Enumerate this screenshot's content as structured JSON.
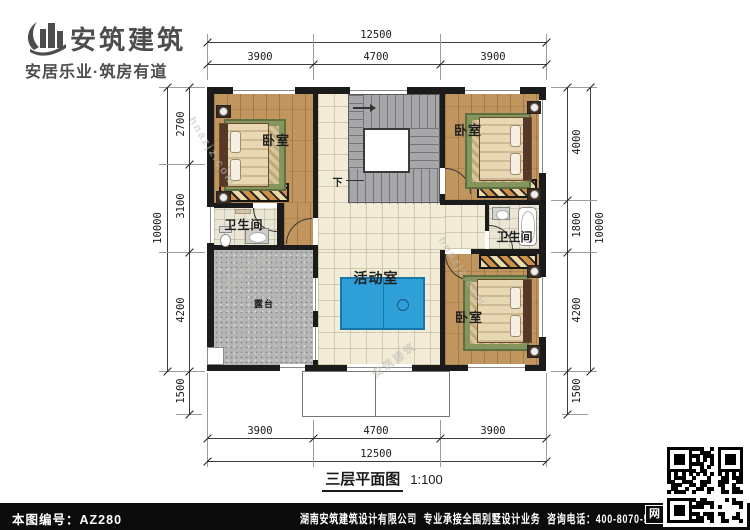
{
  "header": {
    "brand_name": "安筑建筑",
    "tagline": "安居乐业·筑房有道"
  },
  "rooms": {
    "bedroom_tl": "卧室",
    "bedroom_tr": "卧室",
    "bedroom_br": "卧室",
    "bathroom_left": "卫生间",
    "bathroom_right": "卫生间",
    "activity": "活动室",
    "terrace": "露台",
    "stairs_down": "下"
  },
  "dimensions": {
    "top": {
      "total": "12500",
      "segments": [
        "3900",
        "4700",
        "3900"
      ]
    },
    "bottom": {
      "total": "12500",
      "segments": [
        "3900",
        "4700",
        "3900"
      ]
    },
    "left": {
      "total": "10000",
      "segments": [
        "2700",
        "3100",
        "4200"
      ],
      "below": "1500"
    },
    "right": {
      "total": "10000",
      "segments": [
        "4000",
        "1800",
        "4200"
      ],
      "below": "1500"
    }
  },
  "caption": {
    "title": "三层平面图",
    "scale": "1:100"
  },
  "footer": {
    "drawing_no": "本图编号：AZ280",
    "company": "湖南安筑建筑设计有限公司",
    "service": "专业承接全国别墅设计业务",
    "phone": "咨询电话：400-8070-511",
    "web_label": "网"
  },
  "watermarks": {
    "brand": "安筑建筑",
    "site": "hnazjz.com"
  },
  "colors": {
    "wall": "#1b1b1b",
    "wood_floor": "#c0965e",
    "tile_floor": "#f2ecd7",
    "terrace_concrete": "#b6b6b6",
    "stair_gray": "#a7a7a9",
    "table_blue": "#2f9fd8",
    "brand_text": "#4d4d4d",
    "footer_bg": "#0b0b0b"
  }
}
